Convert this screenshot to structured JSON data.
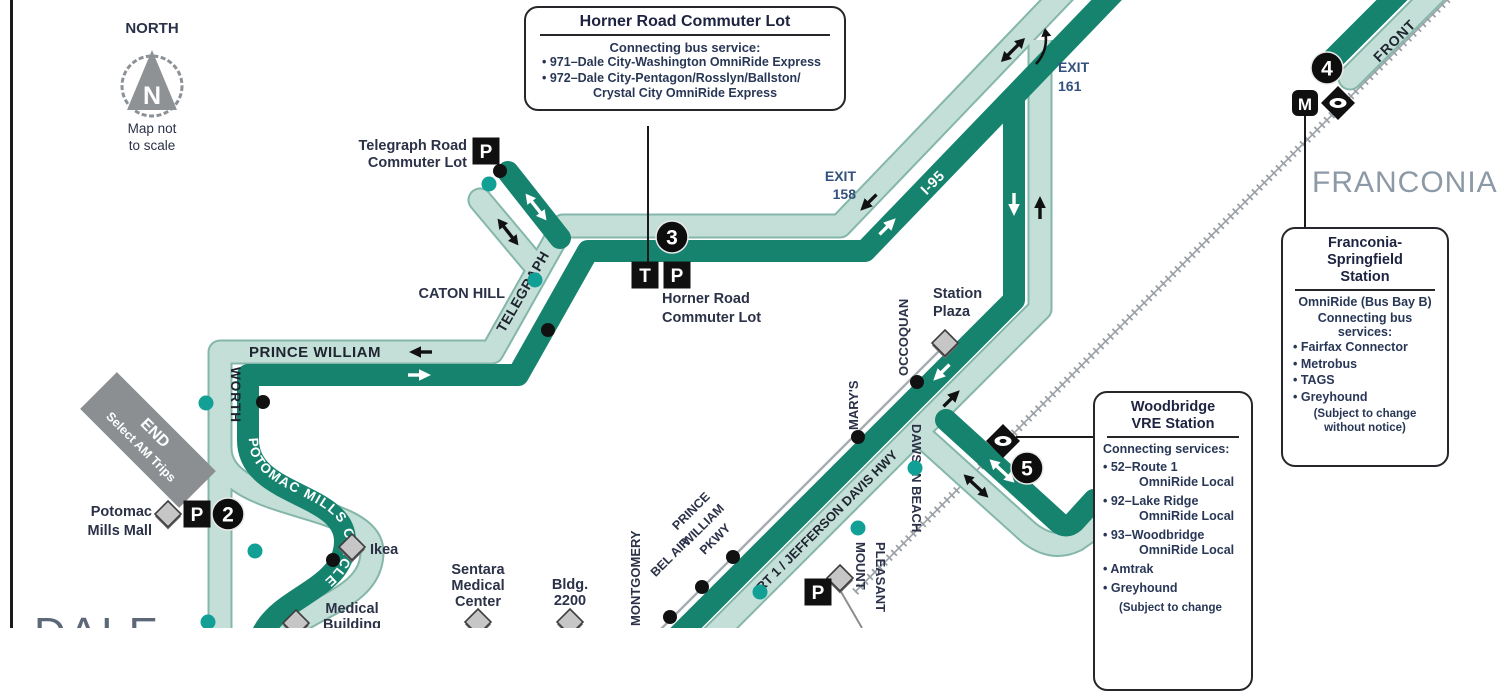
{
  "colors": {
    "route_dark": "#15836E",
    "route_light": "#C4DFD7",
    "route_light_edge": "#84B7A9",
    "rail_gray": "#9BA1A7",
    "label_navy": "#2B3147",
    "exit_blue": "#33517E",
    "callout_text": "#293756",
    "region_gray": "#8C99A6",
    "dale_gray": "#5C6878",
    "teal_dot": "#12A096",
    "banner_gray": "#8B8F92"
  },
  "compass": {
    "label": "NORTH",
    "letter": "N",
    "note1": "Map not",
    "note2": "to scale"
  },
  "banner": {
    "line1": "END",
    "line2": "Select AM Trips"
  },
  "stops": {
    "s2": "2",
    "s3": "3",
    "s4": "4",
    "s5": "5"
  },
  "icons": {
    "parking": "P",
    "transit": "T",
    "metro": "M"
  },
  "exits": {
    "exit158_1": "EXIT",
    "exit158_2": "158",
    "exit161_1": "EXIT",
    "exit161_2": "161"
  },
  "streets": {
    "telegraph": "TELEGRAPH",
    "prince_william": "PRINCE WILLIAM",
    "worth": "WORTH",
    "potomac_circle": "POTOMAC MILLS CIRCLE",
    "caton_hill": "CATON HILL",
    "i95": "I-95",
    "rt1": "RT 1 / JEFFERSON DAVIS HWY",
    "montgomery": "MONTGOMERY",
    "bel_air": "BEL AIR",
    "pw_pkwy_1": "PRINCE",
    "pw_pkwy_2": "WILLIAM",
    "pw_pkwy_3": "PKWY",
    "mount_pleasant_1": "MOUNT",
    "mount_pleasant_2": "PLEASANT",
    "dawson_beach": "DAWSON BEACH",
    "marys": "MARY'S",
    "occoquan": "OCCOQUAN",
    "front": "FRONT"
  },
  "places": {
    "telegraph_lot_1": "Telegraph Road",
    "telegraph_lot_2": "Commuter Lot",
    "horner_lot_1": "Horner Road",
    "horner_lot_2": "Commuter Lot",
    "station_plaza_1": "Station",
    "station_plaza_2": "Plaza",
    "potomac_mall_1": "Potomac",
    "potomac_mall_2": "Mills Mall",
    "ikea": "Ikea",
    "sentara_1": "Sentara",
    "sentara_2": "Medical",
    "sentara_3": "Center",
    "bldg_1": "Bldg.",
    "bldg_2": "2200",
    "medical_1": "Medical",
    "medical_2": "Building",
    "franconia_region": "FRANCONIA",
    "dale_region": "DALE"
  },
  "callouts": {
    "horner": {
      "title": "Horner Road Commuter Lot",
      "subtitle": "Connecting bus service:",
      "b1": "• 971–Dale City-Washington OmniRide Express",
      "b2": "• 972–Dale City-Pentagon/Rosslyn/Ballston/",
      "b2_cont": "Crystal City OmniRide Express"
    },
    "woodbridge": {
      "title1": "Woodbridge",
      "title2": "VRE Station",
      "subtitle": "Connecting services:",
      "b1a": "• 52–Route 1",
      "b1b": "OmniRide Local",
      "b2a": "• 92–Lake Ridge",
      "b2b": "OmniRide Local",
      "b3a": "• 93–Woodbridge",
      "b3b": "OmniRide Local",
      "b4": "• Amtrak",
      "b5": "• Greyhound",
      "note": "(Subject to change"
    },
    "franconia": {
      "title1": "Franconia-",
      "title2": "Springfield",
      "title3": "Station",
      "bay": "OmniRide (Bus Bay B)",
      "subtitle": "Connecting bus services:",
      "b1": "• Fairfax Connector",
      "b2": "• Metrobus",
      "b3": "• TAGS",
      "b4": "• Greyhound",
      "note1": "(Subject to change",
      "note2": "without notice)"
    }
  }
}
